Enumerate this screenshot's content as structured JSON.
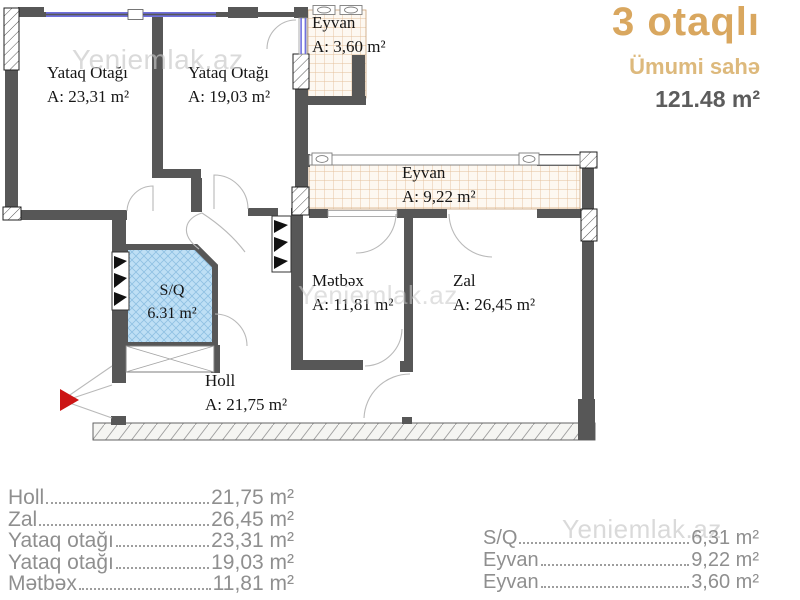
{
  "header": {
    "title": "3 otaqlı",
    "subtitle": "Ümumi sahə",
    "total_area": "121.48 m²"
  },
  "watermark": "Yeniemlak.az",
  "plan": {
    "rooms": [
      {
        "id": "bedroom-1",
        "name": "Yataq Otağı",
        "area": "A: 23,31 m²"
      },
      {
        "id": "bedroom-2",
        "name": "Yataq Otağı",
        "area": "A: 19,03 m²"
      },
      {
        "id": "eyvan-small",
        "name": "Eyvan",
        "area": "A: 3,60 m²"
      },
      {
        "id": "eyvan-large",
        "name": "Eyvan",
        "area": "A: 9,22 m²"
      },
      {
        "id": "kitchen",
        "name": "Mətbəx",
        "area": "A: 11,81 m²"
      },
      {
        "id": "zal",
        "name": "Zal",
        "area": "A: 26,45 m²"
      },
      {
        "id": "sq",
        "name": "S/Q",
        "area": "6.31 m²"
      },
      {
        "id": "hall",
        "name": "Holl",
        "area": "A: 21,75 m²"
      }
    ]
  },
  "legend": {
    "left": [
      {
        "name": "Holl",
        "value": "21,75 m²"
      },
      {
        "name": "Zal",
        "value": "26,45 m²"
      },
      {
        "name": "Yataq otağı",
        "value": "23,31 m²"
      },
      {
        "name": "Yataq otağı",
        "value": "19,03 m²"
      },
      {
        "name": "Mətbəx",
        "value": "11,81 m²"
      }
    ],
    "right": [
      {
        "name": "S/Q",
        "value": "6,31 m²"
      },
      {
        "name": "Eyvan",
        "value": "9,22 m²"
      },
      {
        "name": "Eyvan",
        "value": "3,60 m²"
      }
    ]
  },
  "colors": {
    "wall": "#575757",
    "accent_gold": "#d9a75f",
    "accent_gold_light": "#ddb97c",
    "total_gray": "#5c5c5c",
    "legend_gray": "#8f8f8f",
    "wet_room_blue": "#bedff5",
    "balcony_hatch": "#e4c09a",
    "window_blue": "#7070dd",
    "entrance_red": "#cc1414"
  }
}
